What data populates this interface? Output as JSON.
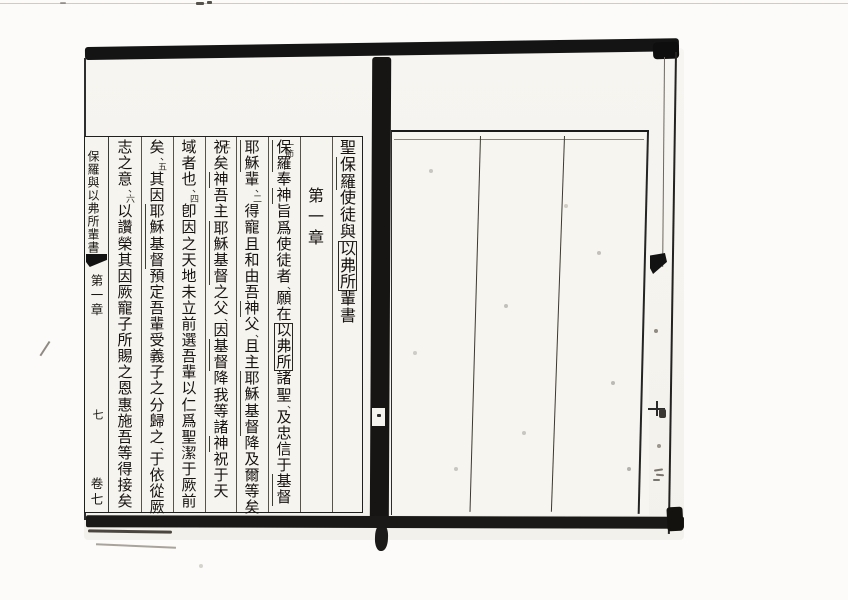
{
  "left_page": {
    "margin_column": {
      "book_title": "保羅與以弗所輩書",
      "chapter": "第一章",
      "leaf_number": "七",
      "volume": "卷七"
    },
    "text_columns": [
      {
        "name": "heading",
        "font": 16,
        "pitch": 16.8,
        "segs": [
          {
            "t": "聖"
          },
          {
            "t": "保羅",
            "mark": "name"
          },
          {
            "t": "使徒與"
          },
          {
            "t": "以弗所",
            "mark": "box"
          },
          {
            "t": "輩書"
          }
        ]
      },
      {
        "name": "chapter-heading",
        "offset": 48,
        "font": 16,
        "pitch": 21,
        "segs": [
          {
            "t": "第一章"
          }
        ]
      },
      {
        "name": "verse-1",
        "segs": [
          {
            "v": "一節",
            "overlap": true
          },
          {
            "t": "保羅",
            "mark": "name"
          },
          {
            "t": "奉"
          },
          {
            "t": "神",
            "mark": "name"
          },
          {
            "t": "旨爲使徒者"
          },
          {
            "p": "、"
          },
          {
            "t": "願在"
          },
          {
            "t": "以弗所",
            "mark": "box"
          },
          {
            "t": "諸聖"
          },
          {
            "p": "、"
          },
          {
            "t": "及忠信于"
          },
          {
            "t": "基督",
            "mark": "name"
          }
        ]
      },
      {
        "name": "verse-2",
        "segs": [
          {
            "t": "耶穌",
            "mark": "name"
          },
          {
            "t": "輩"
          },
          {
            "p": "、"
          },
          {
            "v": "二"
          },
          {
            "t": "得寵且和由吾"
          },
          {
            "t": "神",
            "mark": "name"
          },
          {
            "t": "父"
          },
          {
            "p": "、"
          },
          {
            "t": "且主"
          },
          {
            "t": "耶穌基督",
            "mark": "name"
          },
          {
            "t": "降及爾等矣"
          },
          {
            "p": "、"
          }
        ]
      },
      {
        "name": "verse-3",
        "segs": [
          {
            "v": "三",
            "overlap": true
          },
          {
            "t": "祝矣"
          },
          {
            "t": "神",
            "mark": "name"
          },
          {
            "t": "吾主"
          },
          {
            "t": "耶穌基督",
            "mark": "name"
          },
          {
            "t": "之父"
          },
          {
            "p": "、"
          },
          {
            "t": "因"
          },
          {
            "t": "基督",
            "mark": "name"
          },
          {
            "t": "降我等諸"
          },
          {
            "t": "神",
            "mark": "name"
          },
          {
            "t": "祝于天"
          }
        ]
      },
      {
        "name": "verse-4",
        "segs": [
          {
            "t": "域者也"
          },
          {
            "p": "、"
          },
          {
            "v": "四"
          },
          {
            "t": "卽因之天地未立前選吾輩以仁爲聖潔于厥前"
          }
        ]
      },
      {
        "name": "verse-5",
        "segs": [
          {
            "t": "矣"
          },
          {
            "p": "、"
          },
          {
            "v": "五"
          },
          {
            "t": "其因"
          },
          {
            "t": "耶穌基督",
            "mark": "name"
          },
          {
            "t": "預定吾輩受義子之分歸之"
          },
          {
            "p": "、"
          },
          {
            "t": "于依從厥"
          }
        ]
      },
      {
        "name": "verse-6",
        "segs": [
          {
            "t": "志之意"
          },
          {
            "p": "、"
          },
          {
            "v": "六"
          },
          {
            "t": "以讚榮其因厥寵子所賜之恩惠施吾等得接矣"
          }
        ]
      }
    ]
  },
  "right_page": {
    "content": ""
  }
}
